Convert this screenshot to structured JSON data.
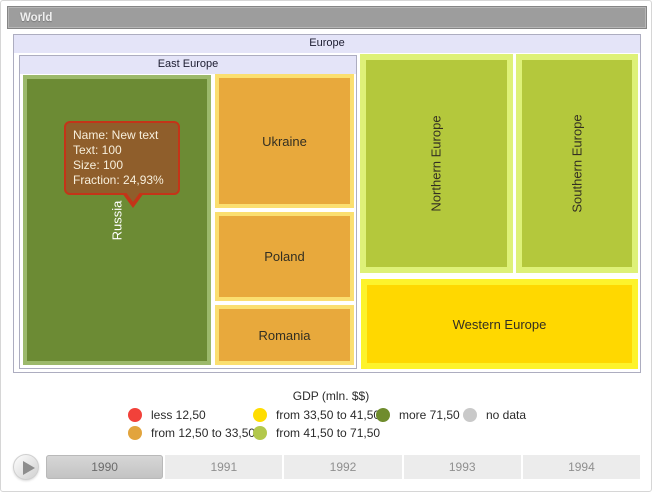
{
  "header": {
    "title": "World"
  },
  "treemap": {
    "europe_label": "Europe",
    "east_europe_label": "East Europe",
    "russia_label": "Russia",
    "ukraine_label": "Ukraine",
    "poland_label": "Poland",
    "romania_label": "Romania",
    "northern_label": "Northern Europe",
    "southern_label": "Southern Europe",
    "western_label": "Western Europe"
  },
  "tooltip": {
    "name_line": "Name: New text",
    "text_line": "Text: 100",
    "size_line": "Size: 100",
    "fraction_line": "Fraction: 24,93%"
  },
  "legend": {
    "title": "GDP (mln. $$)",
    "items": [
      {
        "label": "less 12,50",
        "color": "#f2413a"
      },
      {
        "label": "from 12,50 to 33,50",
        "color": "#e2a43d"
      },
      {
        "label": "from 33,50 to 41,50",
        "color": "#ffdd00"
      },
      {
        "label": "from 41,50 to 71,50",
        "color": "#b3c84c"
      },
      {
        "label": "more 71,50",
        "color": "#6f8c2d"
      },
      {
        "label": "no data",
        "color": "#c9c9c9"
      }
    ]
  },
  "timeline": {
    "years": [
      "1990",
      "1991",
      "1992",
      "1993",
      "1994"
    ],
    "selected": "1990"
  },
  "colors": {
    "world_bar_bg": "#9d9d9d",
    "header_bg": "#e4e4f8",
    "russia_fill": "#6c8b34",
    "russia_border": "#9cb96b",
    "east_orange_fill": "#e8a93c",
    "east_orange_border": "#fbdf70",
    "green_fill": "#b4c83c",
    "green_border": "#def178",
    "yellow_fill": "#ffd800",
    "yellow_border": "#fdf32b",
    "tooltip_bg": "#8f5e2b",
    "tooltip_border": "#c43418"
  },
  "chart_data": {
    "type": "treemap",
    "title": "World",
    "root": "Europe",
    "nodes": [
      {
        "name": "East Europe",
        "parent": "Europe"
      },
      {
        "name": "Russia",
        "parent": "East Europe",
        "value_bin": "more 71,50"
      },
      {
        "name": "Ukraine",
        "parent": "East Europe",
        "value_bin": "from 12,50 to 33,50"
      },
      {
        "name": "Poland",
        "parent": "East Europe",
        "value_bin": "from 12,50 to 33,50"
      },
      {
        "name": "Romania",
        "parent": "East Europe",
        "value_bin": "from 12,50 to 33,50"
      },
      {
        "name": "Northern Europe",
        "parent": "Europe",
        "value_bin": "from 41,50 to 71,50"
      },
      {
        "name": "Southern Europe",
        "parent": "Europe",
        "value_bin": "from 41,50 to 71,50"
      },
      {
        "name": "Western Europe",
        "parent": "Europe",
        "value_bin": "from 33,50 to 41,50"
      }
    ],
    "hovered_point": {
      "name": "New text",
      "text": 100,
      "size": 100,
      "fraction": "24,93%"
    },
    "legend_title": "GDP (mln. $$)",
    "legend_bins": [
      "less 12,50",
      "from 12,50 to 33,50",
      "from 33,50 to 41,50",
      "from 41,50 to 71,50",
      "more 71,50",
      "no data"
    ],
    "timeline_years": [
      1990,
      1991,
      1992,
      1993,
      1994
    ],
    "selected_year": 1990
  }
}
